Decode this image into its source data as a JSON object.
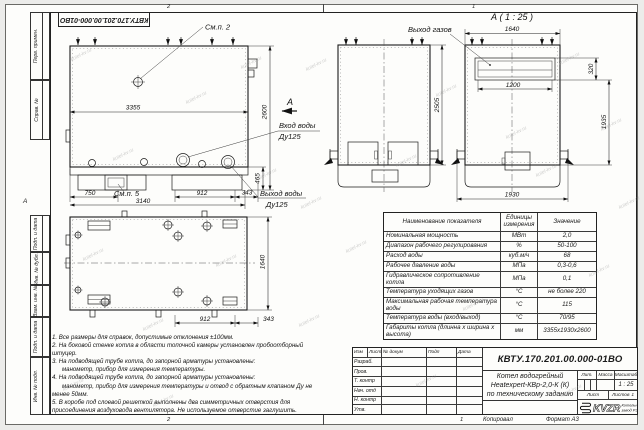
{
  "watermark": "kotel-kv.ru",
  "doc_number": "КВТУ.170.201.00.000-01ВО",
  "zones": {
    "top_left": "2",
    "top_right": "1",
    "bottom_left": "2",
    "bottom_right": "1",
    "side": "А"
  },
  "margin_labels": [
    "Перв. примен.",
    "Справ. №",
    "Подп. и дата",
    "Инв. № дубл.",
    "Взам. инв. №",
    "Подп. и дата",
    "Инв. № подл."
  ],
  "drawing": {
    "callout_2": "См.п. 2",
    "callout_5": "См.п. 5",
    "section_letter": "А",
    "detail_title": "А ( 1 : 25 )",
    "water_inlet_1": "Вход воды",
    "water_inlet_2": "Ду125",
    "water_outlet_1": "Выход воды",
    "water_outlet_2": "Ду125",
    "gas_outlet": "Выход газов",
    "dims": {
      "side_length": "3355",
      "side_height": "2600",
      "base_height": "465",
      "d750": "750",
      "d3140": "3140",
      "d912": "912",
      "d343": "343",
      "front_height": "2505",
      "a_width": "1640",
      "a_opening": "1200",
      "a_opening_h": "320",
      "a_body": "1935",
      "a_bottom": "1930",
      "plan_width": "1640",
      "plan_912": "912",
      "plan_343": "343"
    }
  },
  "table": {
    "headers": [
      "Наименование показателя",
      "Единицы измерения",
      "Значение"
    ],
    "rows": [
      [
        "Номинальная мощность",
        "МВт",
        "2,0"
      ],
      [
        "Диапазон рабочего регулирования",
        "%",
        "50-100"
      ],
      [
        "Расход воды",
        "куб.м/ч",
        "68"
      ],
      [
        "Рабочее давление воды",
        "МПа",
        "0,3-0,6"
      ],
      [
        "Гидравлическое сопротивление котла",
        "МПа",
        "0,1"
      ],
      [
        "Температура уходящих газов",
        "°С",
        "не более 220"
      ],
      [
        "Максимальная рабочая температура воды",
        "°С",
        "115"
      ],
      [
        "Температура воды (вход/выход)",
        "°С",
        "70/95"
      ],
      [
        "Габариты котла (длинна х ширина х высота)",
        "мм",
        "3355х1930х2600"
      ]
    ]
  },
  "notes": [
    "1. Все размеры для справок, допустимые отклонения ±100мм.",
    "2. На боковой стенке котла в области топочной камеры установлен пробоотборный",
    "штуцер.",
    "3. На подводящей трубе котла, до запорной арматуры установлены:",
    "манометр, прибор для измерения температуры.",
    "4. На подводящей трубе котла, до запорной арматуры установлены:",
    "манометр, прибор для измерения температуры и отвод с обратным клапаном Ду не",
    "менее 50мм.",
    "5. В коробе под слоевой решеткой выполнены два симметричных отверстия для",
    "присоединения воздуховода вентилятора. Не используемое отверстие заглушить."
  ],
  "title_block": {
    "doc_number": "КВТУ.170.201.00.000-01ВО",
    "name_1": "Котел водогрейный",
    "name_2": "Heatexpert-КВр-2,0-К (К)",
    "name_3": "по техническому заданию",
    "header_cols": [
      "Изм",
      "Лист",
      "№ докум",
      "Подп",
      "Дата"
    ],
    "rows": [
      "Разраб.",
      "Пров.",
      "Т. контр",
      "Нач. отд",
      "Н. контр",
      "Утв."
    ],
    "lit_label": "Лит.",
    "mass_label": "Масса",
    "scale_label": "Масштаб",
    "scale_value": "1 : 25",
    "sheet_label": "Лист",
    "sheets_label": "Листов",
    "sheets_value": "1",
    "logo_text": "KVZR",
    "logo_caption_1": "Котельный",
    "logo_caption_2": "завод РЭП",
    "kopiroval": "Копировал",
    "format": "Формат А3"
  }
}
